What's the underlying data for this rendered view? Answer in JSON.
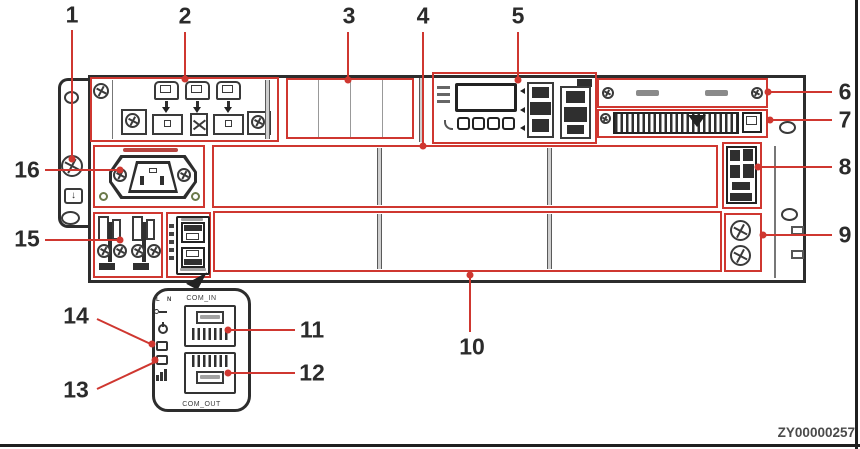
{
  "figure": {
    "watermark": "ZY00000257",
    "colors": {
      "callout_red": "#cf3730",
      "line_dark": "#2d2d2d"
    }
  },
  "callouts": {
    "c1": "1",
    "c2": "2",
    "c3": "3",
    "c4": "4",
    "c5": "5",
    "c6": "6",
    "c7": "7",
    "c8": "8",
    "c9": "9",
    "c10": "10",
    "c11": "11",
    "c12": "12",
    "c13": "13",
    "c14": "14",
    "c15": "15",
    "c16": "16"
  },
  "detail_bubble": {
    "top_port_label": "COM_IN",
    "bottom_port_label": "COM_OUT",
    "pin_l": "L",
    "pin_n": "N"
  },
  "icons": {
    "ground_arrow": "↓"
  }
}
